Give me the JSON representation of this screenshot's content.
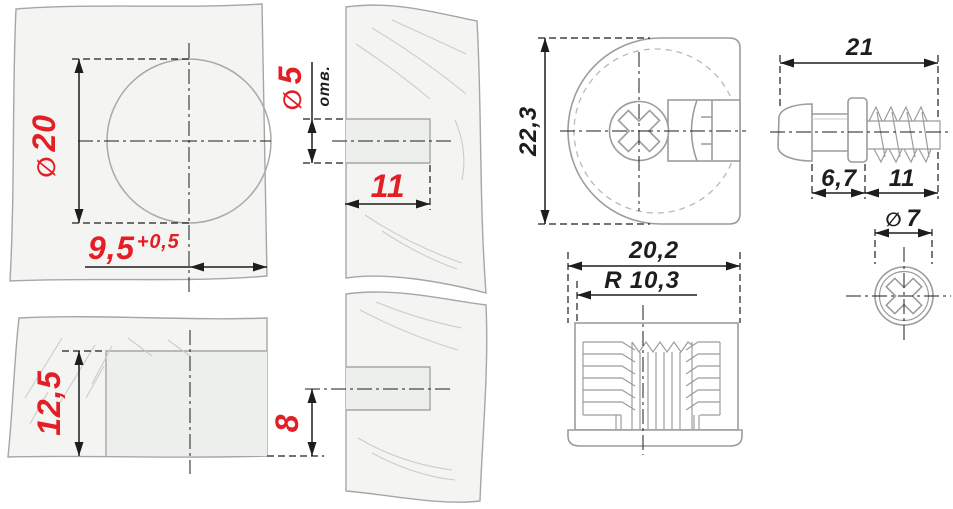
{
  "colors": {
    "dimension_red": "#e31e24",
    "line_black": "#1d1d1b",
    "part_gray": "#9c9c9b",
    "panel_fill": "#f4f4f3",
    "grain_gray": "#cccccb"
  },
  "panel_views": {
    "face_top": {
      "hole_diameter_symbol": "∅",
      "hole_diameter_value": "20",
      "edge_distance_value": "9,5",
      "edge_distance_tolerance": "+0,5"
    },
    "edge_top": {
      "hole_diameter_symbol": "∅",
      "hole_diameter_value": "5",
      "hole_note": "отв.",
      "hole_depth_value": "11"
    },
    "face_bottom": {
      "recess_depth_value": "12,5"
    },
    "edge_bottom": {
      "hole_offset_value": "8"
    }
  },
  "fitting_views": {
    "cam_front": {
      "height_value": "22,3"
    },
    "cam_bottom": {
      "width_value": "20,2",
      "radius_value": "R 10,3"
    },
    "dowel_side": {
      "length_value": "21",
      "neck_value": "6,7",
      "thread_value": "11"
    },
    "dowel_end": {
      "diameter_symbol": "∅",
      "diameter_value": "7"
    }
  }
}
